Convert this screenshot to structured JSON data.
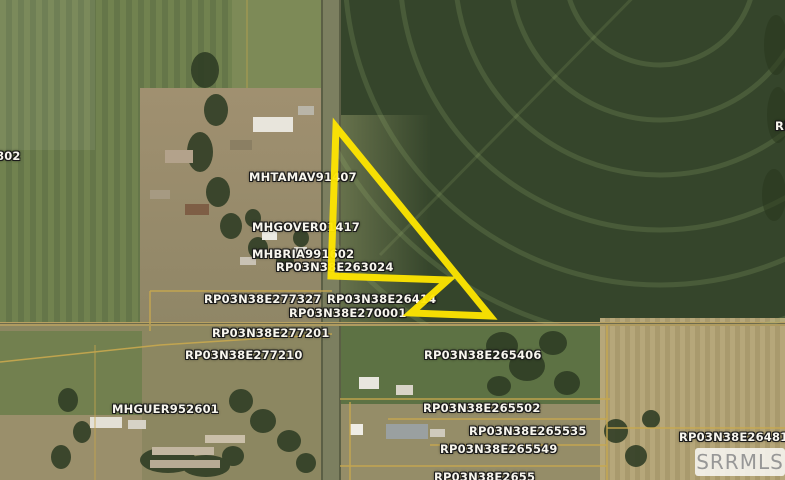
{
  "map": {
    "watermark": "SRRMLS",
    "colors": {
      "highlight": "#ffe600",
      "parcel_line": "#c9a94f",
      "label_text": "#f8f6ee"
    },
    "highlight": {
      "name": "highlighted-parcel",
      "points_str": "336,127 490,316 411,313 448,280 331,276"
    },
    "labels": [
      {
        "text": "802",
        "x": -4,
        "y": 150
      },
      {
        "text": "MHTAMAV91407",
        "x": 249,
        "y": 171
      },
      {
        "text": "MHGOVER01417",
        "x": 252,
        "y": 221
      },
      {
        "text": "MHBRIA991602",
        "x": 252,
        "y": 248
      },
      {
        "text": "RP03N38E263024",
        "x": 276,
        "y": 261
      },
      {
        "text": "RP03N38E277327",
        "x": 204,
        "y": 293
      },
      {
        "text": "RP03N38E26414",
        "x": 327,
        "y": 293
      },
      {
        "text": "RP03N38E270001",
        "x": 289,
        "y": 307
      },
      {
        "text": "RP03N38E277201",
        "x": 212,
        "y": 327
      },
      {
        "text": "RP03N38E277210",
        "x": 185,
        "y": 349
      },
      {
        "text": "RP03N38E265406",
        "x": 424,
        "y": 349
      },
      {
        "text": "MHGUER952601",
        "x": 112,
        "y": 403
      },
      {
        "text": "RP03N38E265502",
        "x": 423,
        "y": 402
      },
      {
        "text": "RP03N38E265535",
        "x": 469,
        "y": 425
      },
      {
        "text": "RP03N38E265549",
        "x": 440,
        "y": 443
      },
      {
        "text": "RP03N38E264813",
        "x": 679,
        "y": 431
      },
      {
        "text": "RP03N38E2655",
        "x": 434,
        "y": 471
      },
      {
        "text": "RP",
        "x": 775,
        "y": 120
      }
    ]
  }
}
